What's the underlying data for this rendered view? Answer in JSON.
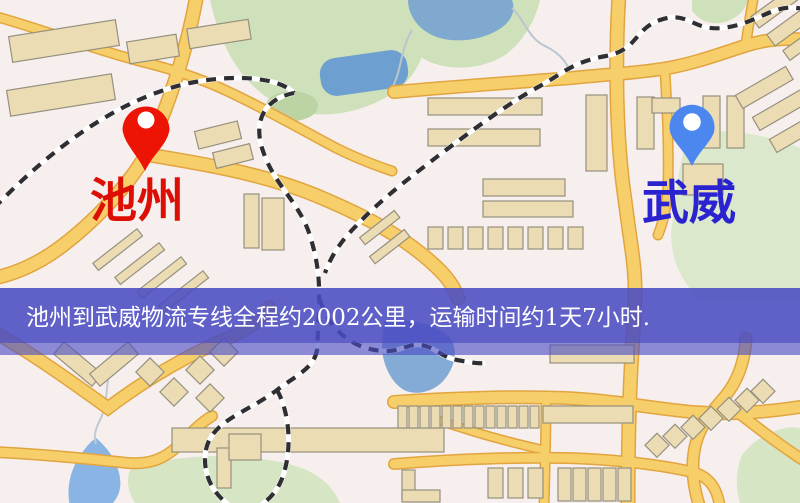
{
  "origin": {
    "name": "池州",
    "pin_icon": "map-pin",
    "pin_color": "#ed1406",
    "label_color": "#dd0e03"
  },
  "destination": {
    "name": "武威",
    "pin_icon": "map-pin",
    "pin_color": "#4c86ef",
    "label_color": "#2a23cf"
  },
  "banner": {
    "text": "池州到武威物流专线全程约2002公里，运输时间约1天7小时.",
    "distance_text": "约2002公里",
    "duration_text": "约1天7小时",
    "background_color": "#4a4cc3",
    "text_color": "#ffffff"
  },
  "map_palette": {
    "background": "#f6efee",
    "road_fill": "#f6cf6a",
    "road_casing": "#e2a43f",
    "park_green": "#cfe1ba",
    "water_blue": "#7fa9ce",
    "building_fill": "#ebdcb4",
    "railway_dark": "#2f2f33"
  }
}
